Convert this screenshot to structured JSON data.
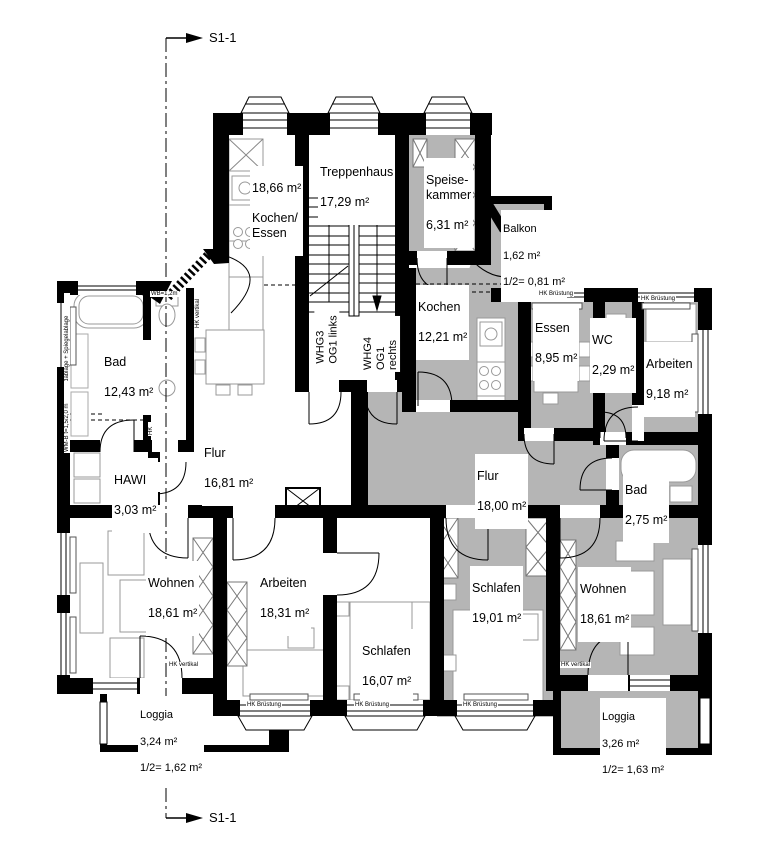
{
  "section": {
    "top_label": "S1-1",
    "bottom_label": "S1-1"
  },
  "apartment_doors": {
    "whg3": "WHG3\nOG1 links",
    "whg4": "WHG4\nOG1 rechts"
  },
  "rooms": {
    "ke": {
      "area": "18,66 m²",
      "name": "Kochen/\nEssen"
    },
    "treppenhaus": {
      "name": "Treppenhaus",
      "area": "17,29 m²"
    },
    "speisekammer": {
      "name": "Speise-\nkammer",
      "area": "6,31 m²"
    },
    "balkon": {
      "name": "Balkon",
      "area": "1,62 m²",
      "half": "1/2= 0,81 m²"
    },
    "kochen": {
      "name": "Kochen",
      "area": "12,21 m²"
    },
    "essen": {
      "name": "Essen",
      "area": "8,95 m²"
    },
    "wc": {
      "name": "WC",
      "area": "2,29 m²"
    },
    "arbeiten_r": {
      "name": "Arbeiten",
      "area": "9,18 m²"
    },
    "bad_l": {
      "name": "Bad",
      "area": "12,43 m²"
    },
    "hawi": {
      "name": "HAWI",
      "area": "3,03 m²"
    },
    "flur_l": {
      "name": "Flur",
      "area": "16,81 m²"
    },
    "flur_r": {
      "name": "Flur",
      "area": "18,00 m²"
    },
    "bad_r": {
      "name": "Bad",
      "area": "2,75 m²"
    },
    "wohnen_l": {
      "name": "Wohnen",
      "area": "18,61 m²"
    },
    "arbeiten_l": {
      "name": "Arbeiten",
      "area": "18,31 m²"
    },
    "schlafen_l": {
      "name": "Schlafen",
      "area": "16,07 m²"
    },
    "schlafen_r": {
      "name": "Schlafen",
      "area": "19,01 m²"
    },
    "wohnen_r": {
      "name": "Wohnen",
      "area": "18,61 m²"
    },
    "loggia_l": {
      "name": "Loggia",
      "area": "3,24 m²",
      "half": "1/2= 1,62 m²"
    },
    "loggia_r": {
      "name": "Loggia",
      "area": "3,26 m²",
      "half": "1/2= 1,63 m²"
    }
  },
  "annotations": {
    "hk_bruestung": "HK Brüstung",
    "hk_vertikal": "HK vertikal",
    "hk": "HK",
    "wb": "WB=1,2m",
    "wall_shelf": "Wandablage + Spiegelablage",
    "wm": "WM-B t=1,5/2,0 m"
  },
  "colors": {
    "right_apartment_fill": "#b5b5b5",
    "wall": "#000000",
    "paper": "#ffffff"
  }
}
